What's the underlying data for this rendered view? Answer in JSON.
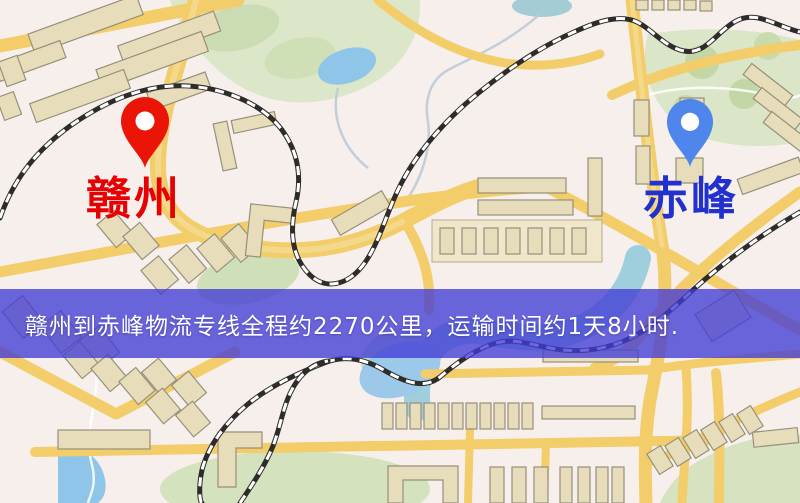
{
  "map": {
    "origin_label": "赣州",
    "destination_label": "赤峰",
    "colors": {
      "origin_label": "#e60202",
      "destination_label": "#2231cd",
      "origin_pin": "#ea1507",
      "destination_pin": "#4e86ec",
      "pin_hole": "#ffffff",
      "road": "#f2cd6a",
      "water": "#8fc5e9",
      "river": "#9fcfdc",
      "park": "#d9e4c4",
      "building": "#e7ddbb",
      "railway": "#2e2c2a",
      "background": "#f7efec"
    }
  },
  "banner": {
    "text": "赣州到赤峰物流专线全程约2270公里，运输时间约1天8小时.",
    "origin": "赣州",
    "destination": "赤峰",
    "distance": "约2270公里",
    "duration": "约1天8小时",
    "background": "rgba(67,60,214,0.78)",
    "text_color": "#ffffff"
  }
}
